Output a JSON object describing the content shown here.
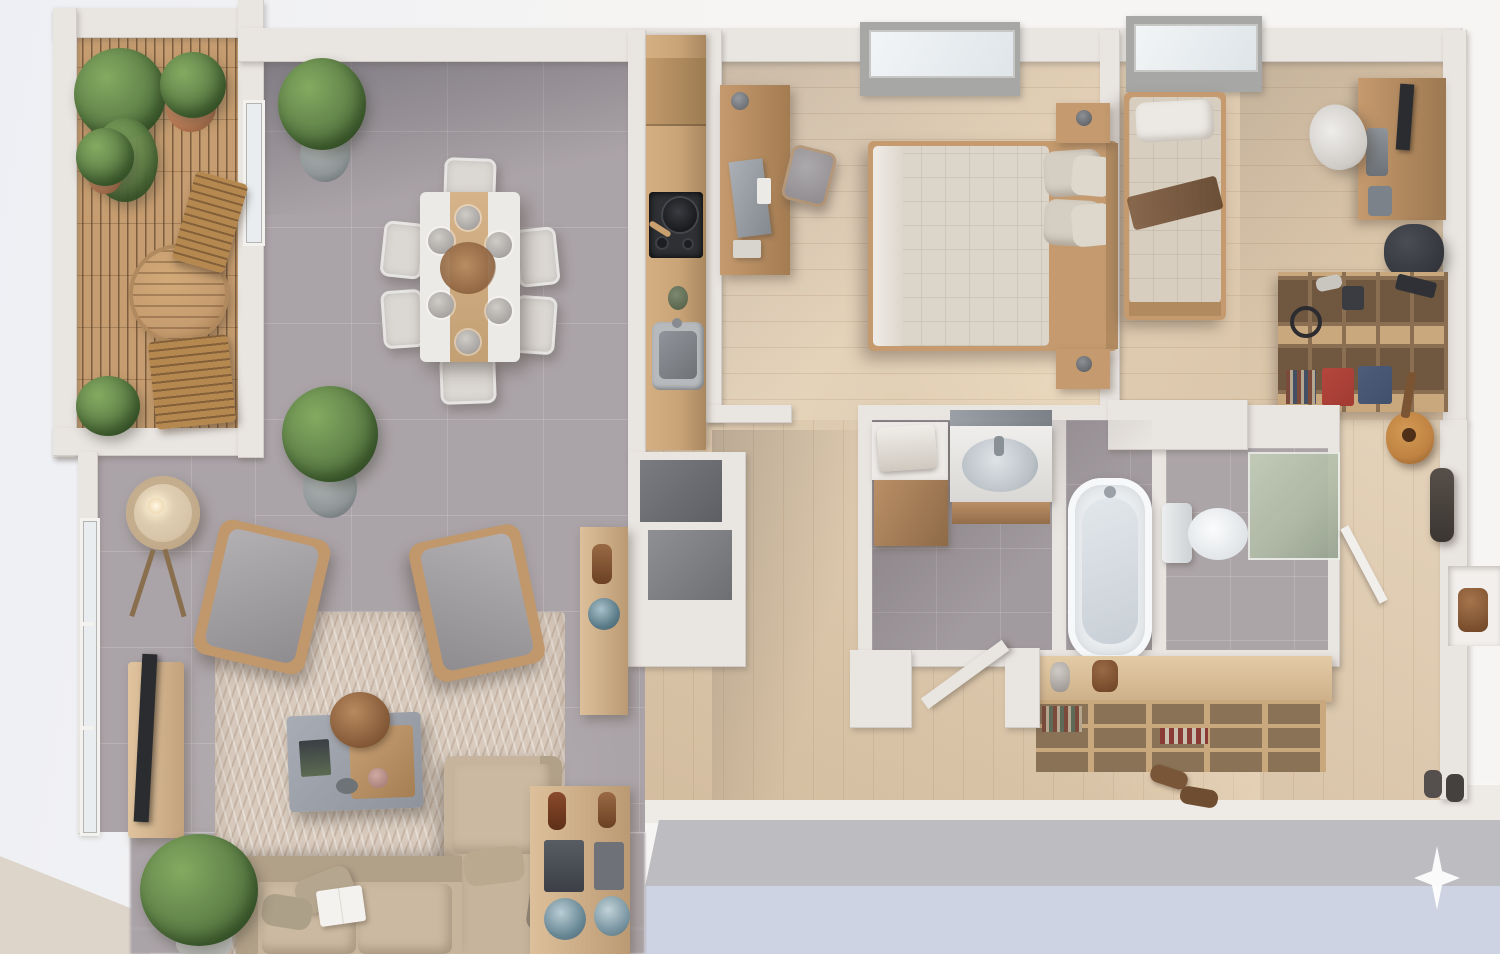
{
  "meta": {
    "title": "Top-down 3D apartment floor plan render",
    "view": "dollhouse top view, photorealistic, no visible text"
  },
  "palette": {
    "bg_top": "#f7f5f3",
    "bg_left": "#edeff4",
    "corner_beige": "#ddd4ca",
    "band_wall": "#eeeae6",
    "band_gray": "#bdbcc1",
    "band_blue": "#cdd3e3",
    "wall": "#e9e5e1",
    "wall_dark": "#d4cec9",
    "tile": "#aaa3a7",
    "wood": "#e2cdb0",
    "wood_hall": "#dfcaad",
    "deck": "#c69d70",
    "kitchen_wood": "#c9a477",
    "appliance_dark": "#2e3034",
    "steel": "#b7babd",
    "sofa": "#c6b49c",
    "sofa_dark": "#b2a189",
    "rug": "#d8cbbe",
    "armchair": "#a3a0a3",
    "chair_wood": "#c1976c",
    "table_white": "#eceae6",
    "chair_white": "#dbd7d3",
    "bed_duvet": "#dcd5c9",
    "pillow": "#d5cec2",
    "bed_wood": "#c49a6e",
    "plant": "#5f8148",
    "plant_dark": "#3c5a2e",
    "terracotta": "#b87953",
    "pot_gray": "#8f9697",
    "bath_tile": "#a19a9e",
    "tub_white": "#ebeef0",
    "glass_green": "#afbaa4",
    "tv_dark": "#2b2c30",
    "lamp_shade": "#d8c5a9",
    "red_bin": "#a23a33",
    "blue_bin": "#41506b",
    "guitar_wood": "#c08342",
    "sparkle": "#ffffff"
  },
  "rooms": [
    {
      "id": "balcony",
      "items": [
        "deck-boards",
        "bistro-table",
        "folding-chair-upper",
        "folding-chair-lower",
        "potted-plants"
      ]
    },
    {
      "id": "dining-area",
      "items": [
        "dining-table",
        "table-runner",
        "six-chairs",
        "place-settings",
        "potted-plant"
      ]
    },
    {
      "id": "kitchen",
      "items": [
        "counter",
        "cooktop",
        "frying-pan",
        "sink",
        "utensil-crock"
      ]
    },
    {
      "id": "living-room",
      "items": [
        "sectional-sofa",
        "armchair-left",
        "armchair-right",
        "coffee-table",
        "area-rug",
        "tv-console",
        "tv",
        "floor-lamp",
        "console-table",
        "potted-plants",
        "window-wall"
      ]
    },
    {
      "id": "master-bedroom",
      "items": [
        "double-bed",
        "pillows",
        "nightstand-top",
        "nightstand-bottom",
        "desk",
        "desk-chair",
        "window"
      ]
    },
    {
      "id": "bedroom-2",
      "items": [
        "single-bed",
        "desk",
        "monitor",
        "office-chair",
        "cube-shelf",
        "red-bin",
        "blue-bin",
        "headphones",
        "beanbag",
        "guitar",
        "window"
      ]
    },
    {
      "id": "bathroom",
      "items": [
        "vanity-sink",
        "mirror",
        "towel-cabinet",
        "bathtub",
        "toilet",
        "shower-glass"
      ]
    },
    {
      "id": "hall-entry",
      "items": [
        "closet-boxes",
        "entry-door",
        "bookshelf-sideboard",
        "decor-objects",
        "coat-rack",
        "shoes",
        "storage-niche"
      ]
    }
  ],
  "watermark": {
    "icon": "sparkle-icon",
    "color": "#ffffff"
  }
}
